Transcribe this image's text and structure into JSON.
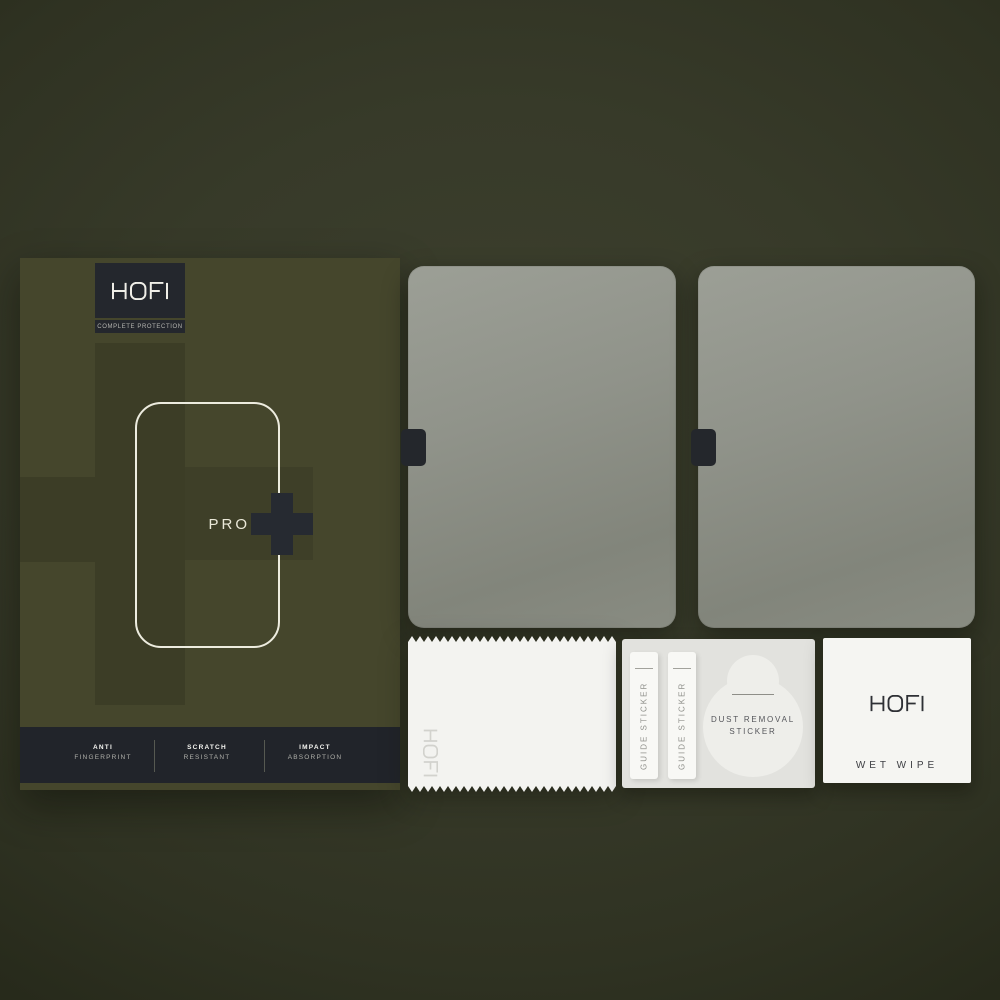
{
  "package": {
    "brand": "HOFI",
    "tagline": "COMPLETE PROTECTION",
    "model": "PRO",
    "features": [
      {
        "line1": "ANTI",
        "line2": "FINGERPRINT"
      },
      {
        "line1": "SCRATCH",
        "line2": "RESISTANT"
      },
      {
        "line1": "IMPACT",
        "line2": "ABSORPTION"
      }
    ]
  },
  "accessories": {
    "cloth_brand": "HOFI",
    "guide_stickers": [
      "GUIDE STICKER",
      "GUIDE STICKER"
    ],
    "dust_sticker": {
      "line1": "DUST REMOVAL",
      "line2": "STICKER"
    },
    "wet_wipe": {
      "brand": "HOFI",
      "label": "WET WIPE"
    }
  },
  "colors": {
    "background_olive": "#373a29",
    "box_olive": "#45462c",
    "dark_panel": "#21242a",
    "plus_accent": "#262a31",
    "glass_gray": "#8d9087",
    "cloth_white": "#f3f3f0"
  }
}
